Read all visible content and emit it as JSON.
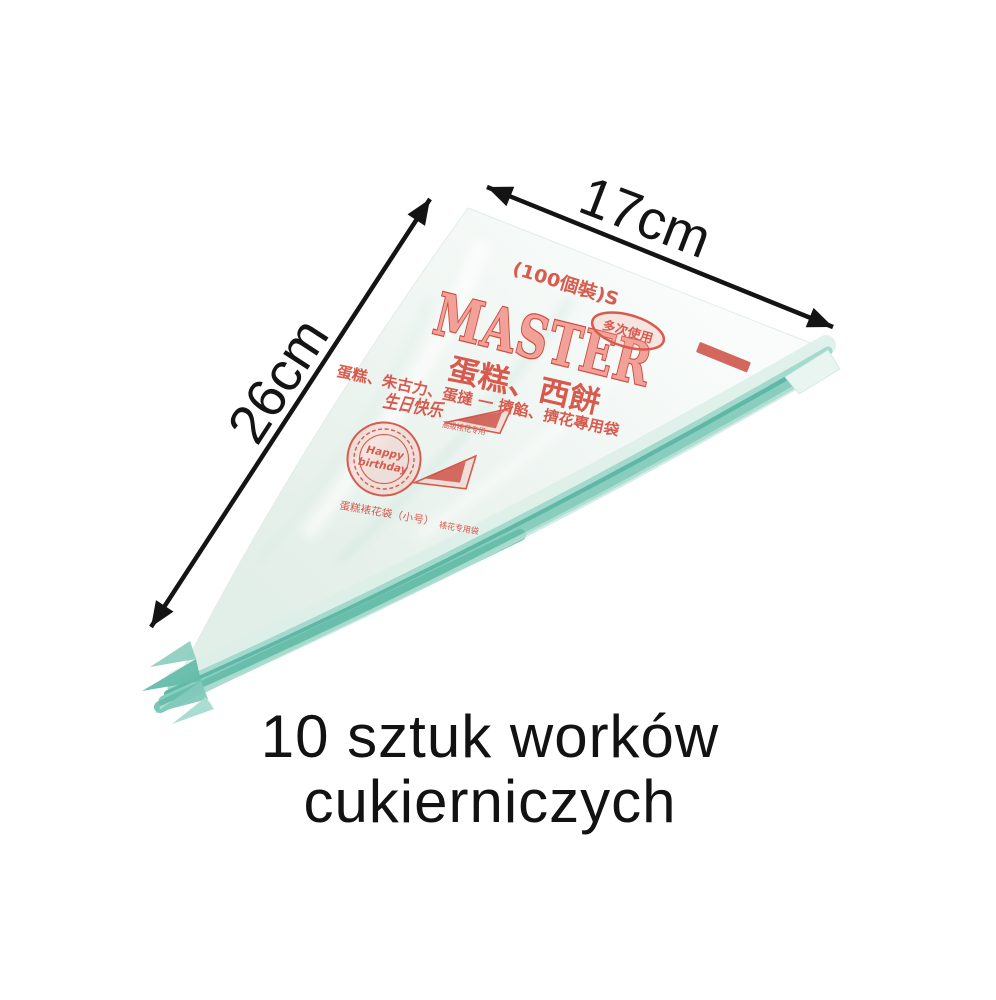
{
  "page": {
    "background": "#ffffff"
  },
  "annotations": {
    "width_label": "17cm",
    "length_label": "26cm"
  },
  "caption": {
    "line1": "10 sztuk worków",
    "line2": "cukierniczych"
  },
  "bag_print": {
    "pack_info": "(100個裝)S",
    "brand": "MASTER",
    "badge": "多次使用",
    "product_line": "蛋糕、西餅",
    "usage_line": "蛋糕、朱古力、蛋撻 一 擠餡、擠花專用袋",
    "birthday_logo": "生日快乐",
    "birthday_note": "高级裱花专用",
    "stamp_line1": "Happy",
    "stamp_line2": "birthday",
    "cone_note": "裱花专用袋",
    "bottom_note": "蛋糕裱花袋（小号）",
    "dash_mark": "一"
  },
  "colors": {
    "page_bg": "#ffffff",
    "annotation_black": "#141414",
    "caption_black": "#121212",
    "print_red": "#d64a3c",
    "print_dark_red": "#c93a2e",
    "print_fill": "#f2988e",
    "teal_mid": "#5fb8a5",
    "teal_light": "#a3dacd",
    "bag_light": "#f8fcfa",
    "bag_shade": "#e4efe9"
  }
}
